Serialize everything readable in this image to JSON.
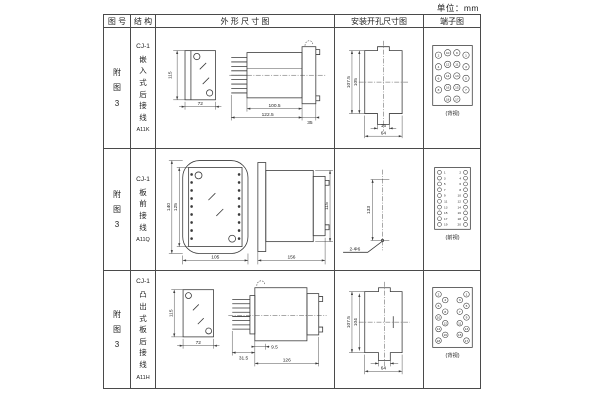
{
  "unit_label": "单位：mm",
  "header": {
    "figure_no": "图 号",
    "structure": "结 构",
    "outline": "外 形 尺 寸 图",
    "install": "安装开孔尺寸图",
    "terminal": "端子图"
  },
  "rows": [
    {
      "figure_no": "附图3",
      "structure": {
        "model": "CJ-1",
        "desc": "嵌入式后接线",
        "code": "A11K"
      },
      "outline": {
        "front_h": "115",
        "front_w": "72",
        "len_body": "100.5",
        "len_total": "122.5",
        "flange": "35"
      },
      "install": {
        "height_outer": "107.5",
        "height_inner": "105",
        "slot": "16",
        "width": "64"
      },
      "terminal": {
        "caption": "(背视)",
        "r": 3.3,
        "circles": [
          {
            "x": 14,
            "y": 16,
            "n": "2"
          },
          {
            "x": 23.5,
            "y": 13.5,
            "n": "10"
          },
          {
            "x": 33,
            "y": 13.5,
            "n": "9"
          },
          {
            "x": 42.5,
            "y": 16,
            "n": "1"
          },
          {
            "x": 14,
            "y": 28,
            "n": "4"
          },
          {
            "x": 23.5,
            "y": 25.5,
            "n": "12"
          },
          {
            "x": 33,
            "y": 25.5,
            "n": "11"
          },
          {
            "x": 42.5,
            "y": 28,
            "n": "3"
          },
          {
            "x": 14,
            "y": 40,
            "n": "6"
          },
          {
            "x": 23.5,
            "y": 37.5,
            "n": "14"
          },
          {
            "x": 33,
            "y": 37.5,
            "n": "13"
          },
          {
            "x": 42.5,
            "y": 40,
            "n": "5"
          },
          {
            "x": 14,
            "y": 52,
            "n": "8"
          },
          {
            "x": 23.5,
            "y": 49.5,
            "n": "16"
          },
          {
            "x": 33,
            "y": 49.5,
            "n": "15"
          },
          {
            "x": 42.5,
            "y": 52,
            "n": "7"
          },
          {
            "x": 23.5,
            "y": 61.5,
            "n": "18"
          },
          {
            "x": 33,
            "y": 61.5,
            "n": "17"
          }
        ]
      }
    },
    {
      "figure_no": "附图3",
      "structure": {
        "model": "CJ-1",
        "desc": "板前接线",
        "code": "A11Q"
      },
      "outline": {
        "front_h_outer": "140",
        "front_h_inner": "125",
        "front_w": "105",
        "len": "156",
        "side_h": "115"
      },
      "install": {
        "hole_dist": "133",
        "holes": "2-Φ6"
      },
      "terminal": {
        "caption": "(前视)",
        "r": 2,
        "circles": [
          {
            "x": 15,
            "y": 11,
            "n": "1",
            "lx": 20.5
          },
          {
            "x": 15,
            "y": 17,
            "n": "3",
            "lx": 20.5
          },
          {
            "x": 15,
            "y": 23,
            "n": "5",
            "lx": 20.5
          },
          {
            "x": 15,
            "y": 29,
            "n": "7",
            "lx": 20.5
          },
          {
            "x": 15,
            "y": 35,
            "n": "9",
            "lx": 20.5
          },
          {
            "x": 15,
            "y": 41,
            "n": "11",
            "lx": 21.5
          },
          {
            "x": 15,
            "y": 47,
            "n": "13",
            "lx": 21.5
          },
          {
            "x": 15,
            "y": 53,
            "n": "15",
            "lx": 21.5
          },
          {
            "x": 15,
            "y": 59,
            "n": "17",
            "lx": 21.5
          },
          {
            "x": 15,
            "y": 65,
            "n": "19",
            "lx": 21.5
          },
          {
            "x": 42,
            "y": 11,
            "n": "2",
            "lx": 36.5
          },
          {
            "x": 42,
            "y": 17,
            "n": "4",
            "lx": 36.5
          },
          {
            "x": 42,
            "y": 23,
            "n": "6",
            "lx": 36.5
          },
          {
            "x": 42,
            "y": 29,
            "n": "8",
            "lx": 36.5
          },
          {
            "x": 42,
            "y": 35,
            "n": "10",
            "lx": 35.5
          },
          {
            "x": 42,
            "y": 41,
            "n": "12",
            "lx": 35.5
          },
          {
            "x": 42,
            "y": 47,
            "n": "14",
            "lx": 35.5
          },
          {
            "x": 42,
            "y": 53,
            "n": "16",
            "lx": 35.5
          },
          {
            "x": 42,
            "y": 59,
            "n": "18",
            "lx": 35.5
          },
          {
            "x": 42,
            "y": 65,
            "n": "20",
            "lx": 35.5
          }
        ]
      }
    },
    {
      "figure_no": "附图3",
      "structure": {
        "model": "CJ-1",
        "desc": "凸出式板后接线",
        "code": "A11H"
      },
      "outline": {
        "front_h": "115",
        "front_w": "72",
        "pins": "31.5",
        "lip": "9.5",
        "len": "126"
      },
      "install": {
        "height_outer": "107.5",
        "height_inner": "104",
        "width": "64"
      },
      "terminal": {
        "caption": "(背视)",
        "r": 2.9,
        "circles": [
          {
            "x": 14,
            "y": 13,
            "n": "2"
          },
          {
            "x": 21,
            "y": 19,
            "n": "4"
          },
          {
            "x": 14,
            "y": 25,
            "n": "6"
          },
          {
            "x": 21,
            "y": 31,
            "n": "8"
          },
          {
            "x": 14,
            "y": 37,
            "n": "10"
          },
          {
            "x": 21,
            "y": 43,
            "n": "12"
          },
          {
            "x": 14,
            "y": 49,
            "n": "14"
          },
          {
            "x": 21,
            "y": 55,
            "n": "16"
          },
          {
            "x": 14,
            "y": 61,
            "n": "18"
          },
          {
            "x": 43,
            "y": 13,
            "n": "1"
          },
          {
            "x": 36,
            "y": 19,
            "n": "3"
          },
          {
            "x": 43,
            "y": 25,
            "n": "5"
          },
          {
            "x": 36,
            "y": 31,
            "n": "7"
          },
          {
            "x": 43,
            "y": 37,
            "n": "9"
          },
          {
            "x": 36,
            "y": 43,
            "n": "11"
          },
          {
            "x": 43,
            "y": 49,
            "n": "13"
          },
          {
            "x": 36,
            "y": 55,
            "n": "15"
          },
          {
            "x": 43,
            "y": 61,
            "n": "17"
          }
        ]
      }
    }
  ]
}
